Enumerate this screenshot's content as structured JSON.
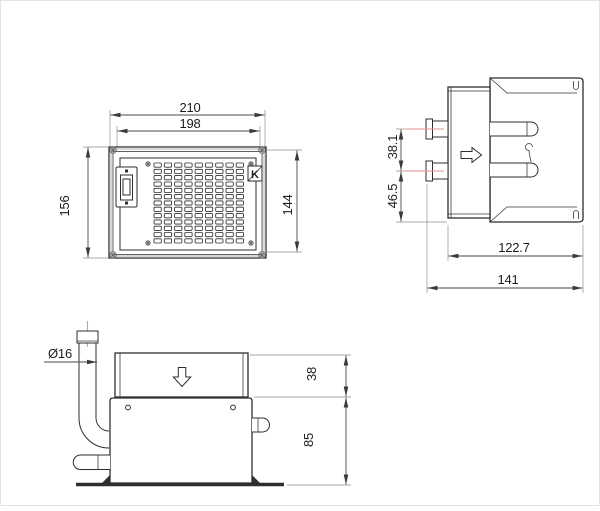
{
  "colors": {
    "line": "#2e2e2e",
    "dimension": "#4a4a4a",
    "centerline_red": "#e89090",
    "frame_shade": "#d8d8d8",
    "background": "#ffffff"
  },
  "front_view": {
    "logo": "K",
    "dims": {
      "width_outer": "210",
      "width_inner": "198",
      "height_outer": "156",
      "height_inner": "144"
    }
  },
  "side_view": {
    "dims": {
      "pipe_spacing": "38.1",
      "pipe_to_base": "46.5",
      "depth_inner": "122.7",
      "depth_outer": "141"
    }
  },
  "bottom_view": {
    "dims": {
      "pipe_diameter": "Ø16",
      "upper_height": "38",
      "lower_height": "85"
    }
  }
}
